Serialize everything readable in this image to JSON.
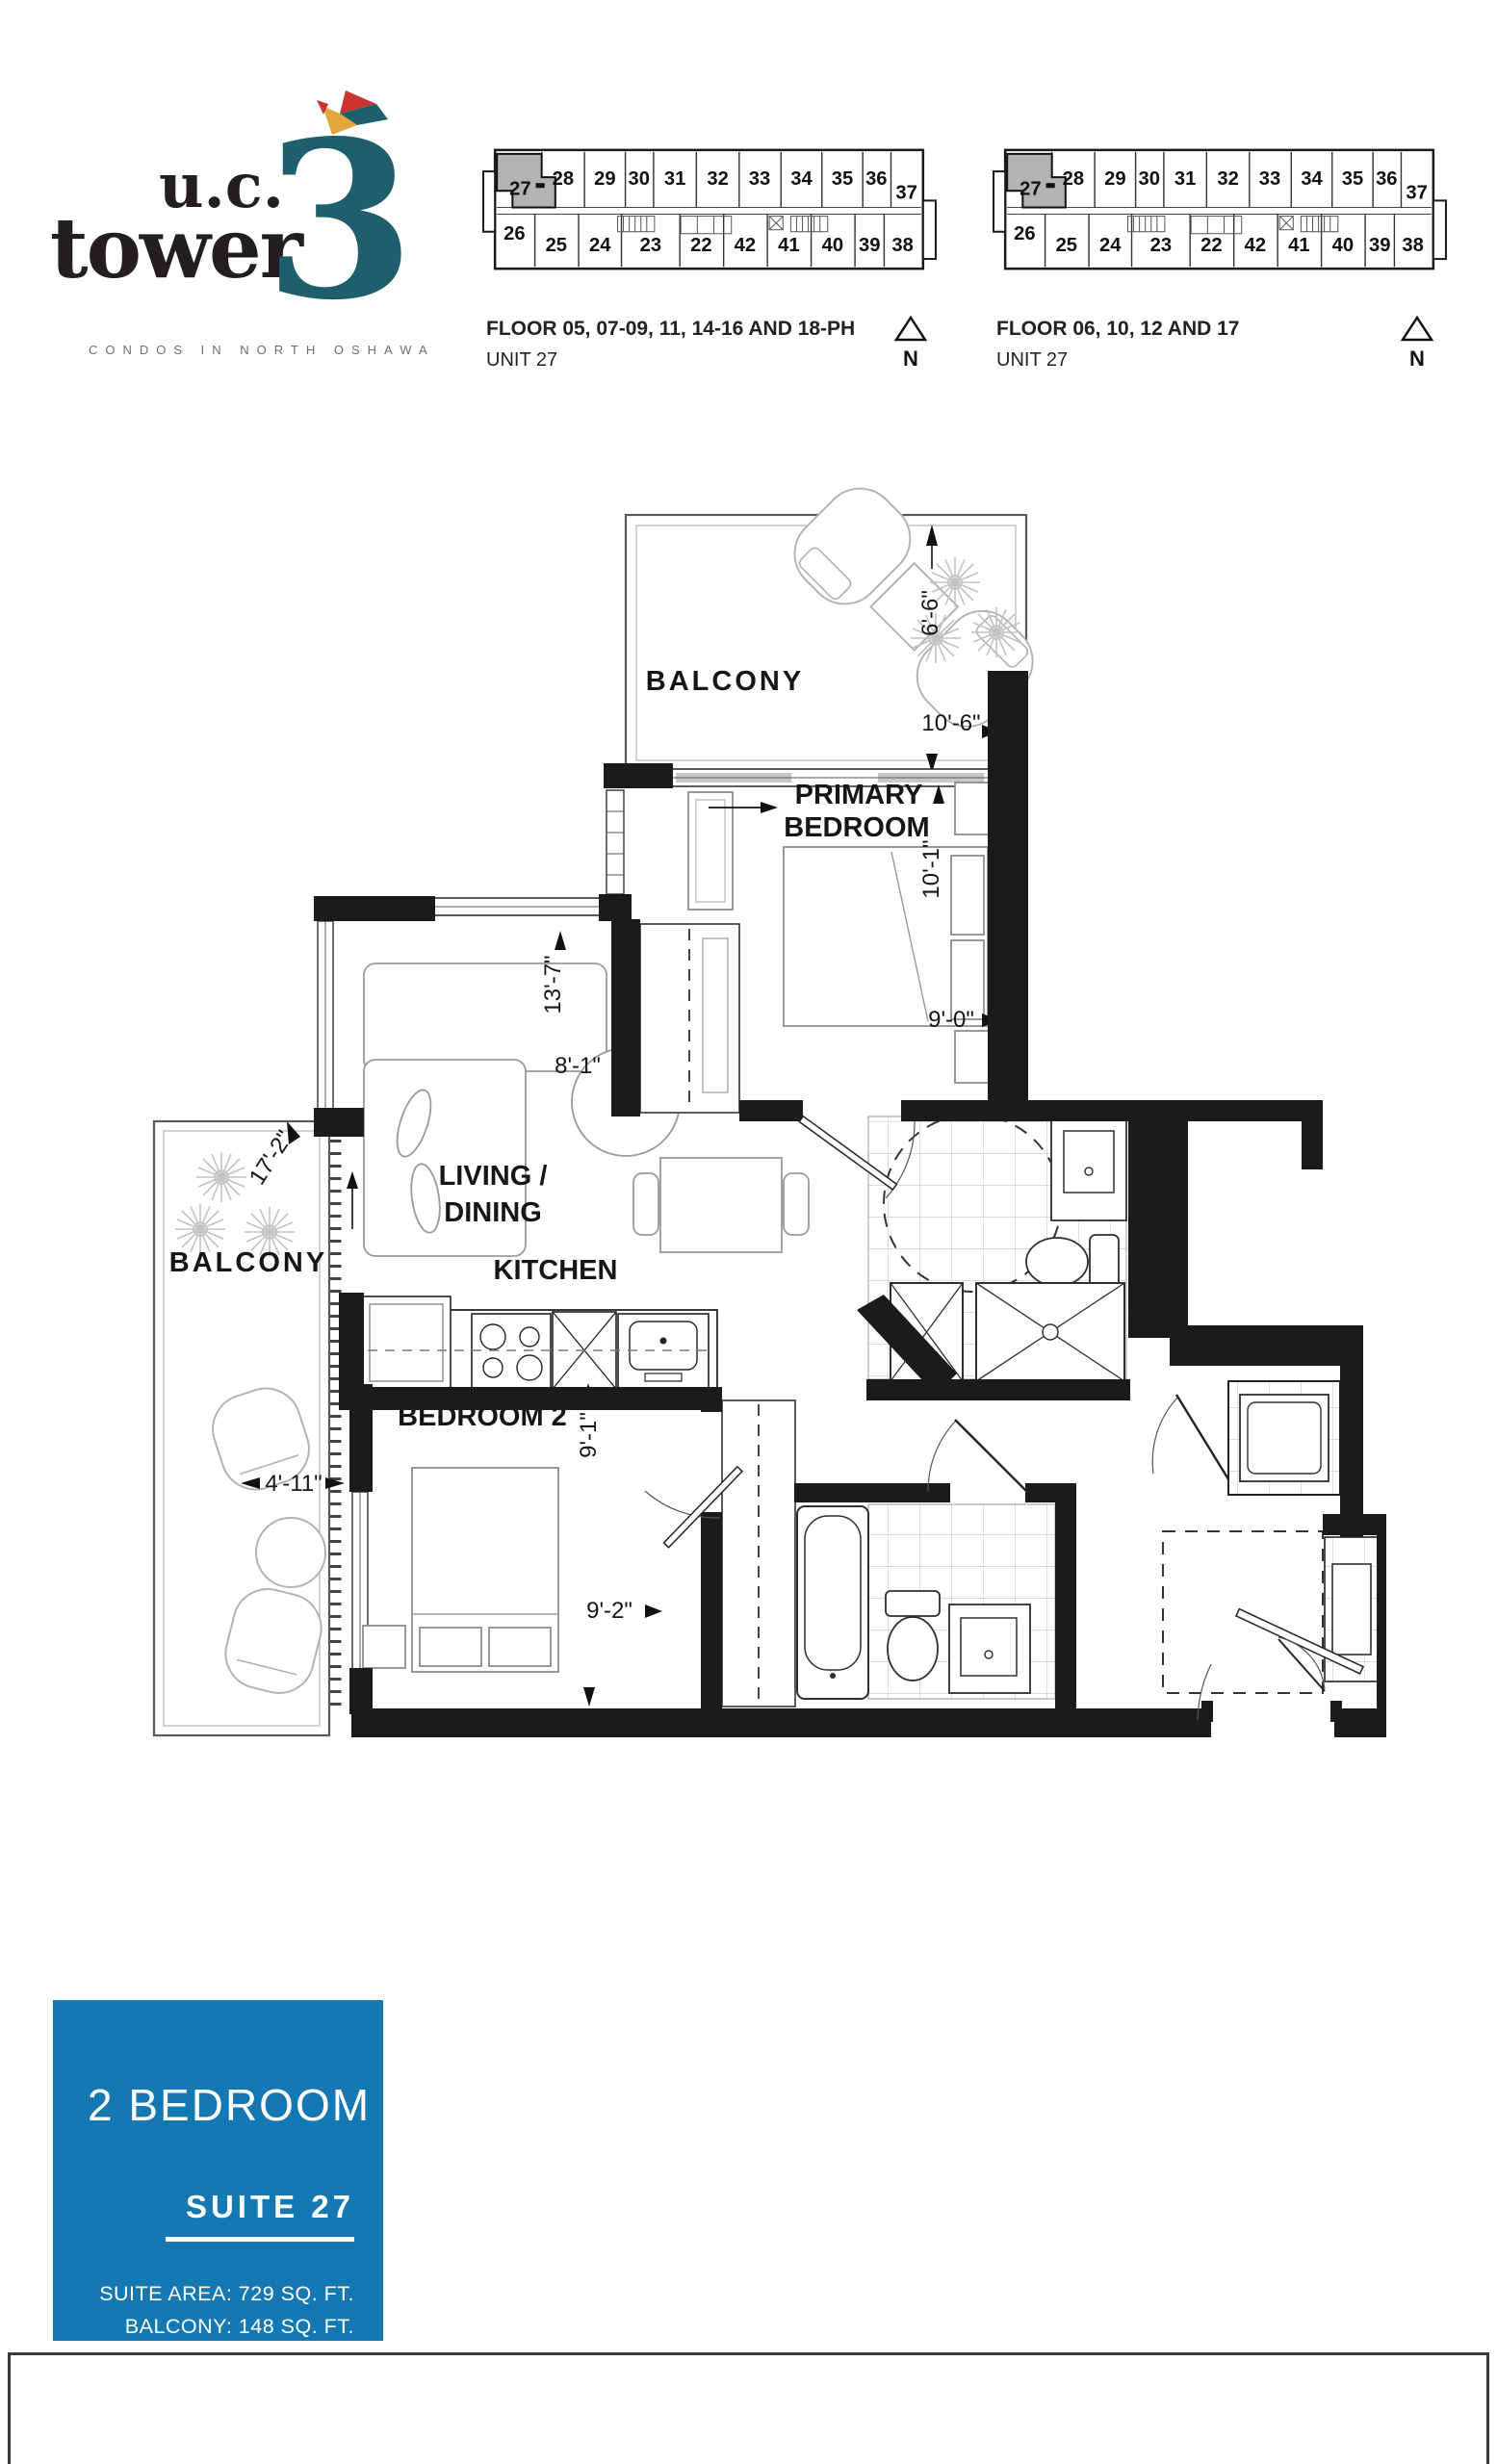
{
  "logo": {
    "word1": "u.c.",
    "word2": "tower",
    "number": "3",
    "tagline": "CONDOS IN NORTH OSHAWA"
  },
  "keyplans": [
    {
      "caption_line1": "FLOOR 05, 07-09, 11, 14-16 AND 18-PH",
      "caption_line2": "UNIT 27",
      "north_label": "N"
    },
    {
      "caption_line1": "FLOOR 06, 10, 12 AND 17",
      "caption_line2": "UNIT 27",
      "north_label": "N"
    }
  ],
  "keyplan_units": {
    "highlighted": "27",
    "top_row": [
      "27",
      "28",
      "29",
      "30",
      "31",
      "32",
      "33",
      "34",
      "35",
      "36",
      "37"
    ],
    "bottom_row": [
      "26",
      "25",
      "24",
      "23",
      "22",
      "42",
      "41",
      "40",
      "39",
      "38"
    ]
  },
  "floorplan": {
    "balcony_top": {
      "label": "BALCONY",
      "dim_depth": "6'-6\"",
      "dim_width": "10'-6\""
    },
    "primary_bedroom": {
      "label_line1": "PRIMARY",
      "label_line2": "BEDROOM",
      "dim_depth": "10'-1\"",
      "dim_width": "9'-0\""
    },
    "living_dining": {
      "label_line1": "LIVING /",
      "label_line2": "DINING",
      "dim_depth": "13'-7\"",
      "dim_width": "8'-1\""
    },
    "kitchen": {
      "label": "KITCHEN",
      "dim": "9'-1\""
    },
    "bedroom2": {
      "label": "BEDROOM 2",
      "dim": "9'-2\""
    },
    "balcony_left": {
      "label": "BALCONY",
      "dim_depth": "17'-2\"",
      "dim_width": "4'-11\""
    }
  },
  "infobox": {
    "type_label": "2 BEDROOM",
    "suite_label": "SUITE 27",
    "area_line1": "SUITE AREA: 729 SQ. FT.",
    "area_line2": "BALCONY: 148 SQ. FT.",
    "bg_color": "#1478b2"
  },
  "colors": {
    "accent_teal": "#1e5f6d",
    "logo_black": "#231f20",
    "tagline_gray": "#6d6e71",
    "highlight_gray": "#b3b3b3"
  }
}
